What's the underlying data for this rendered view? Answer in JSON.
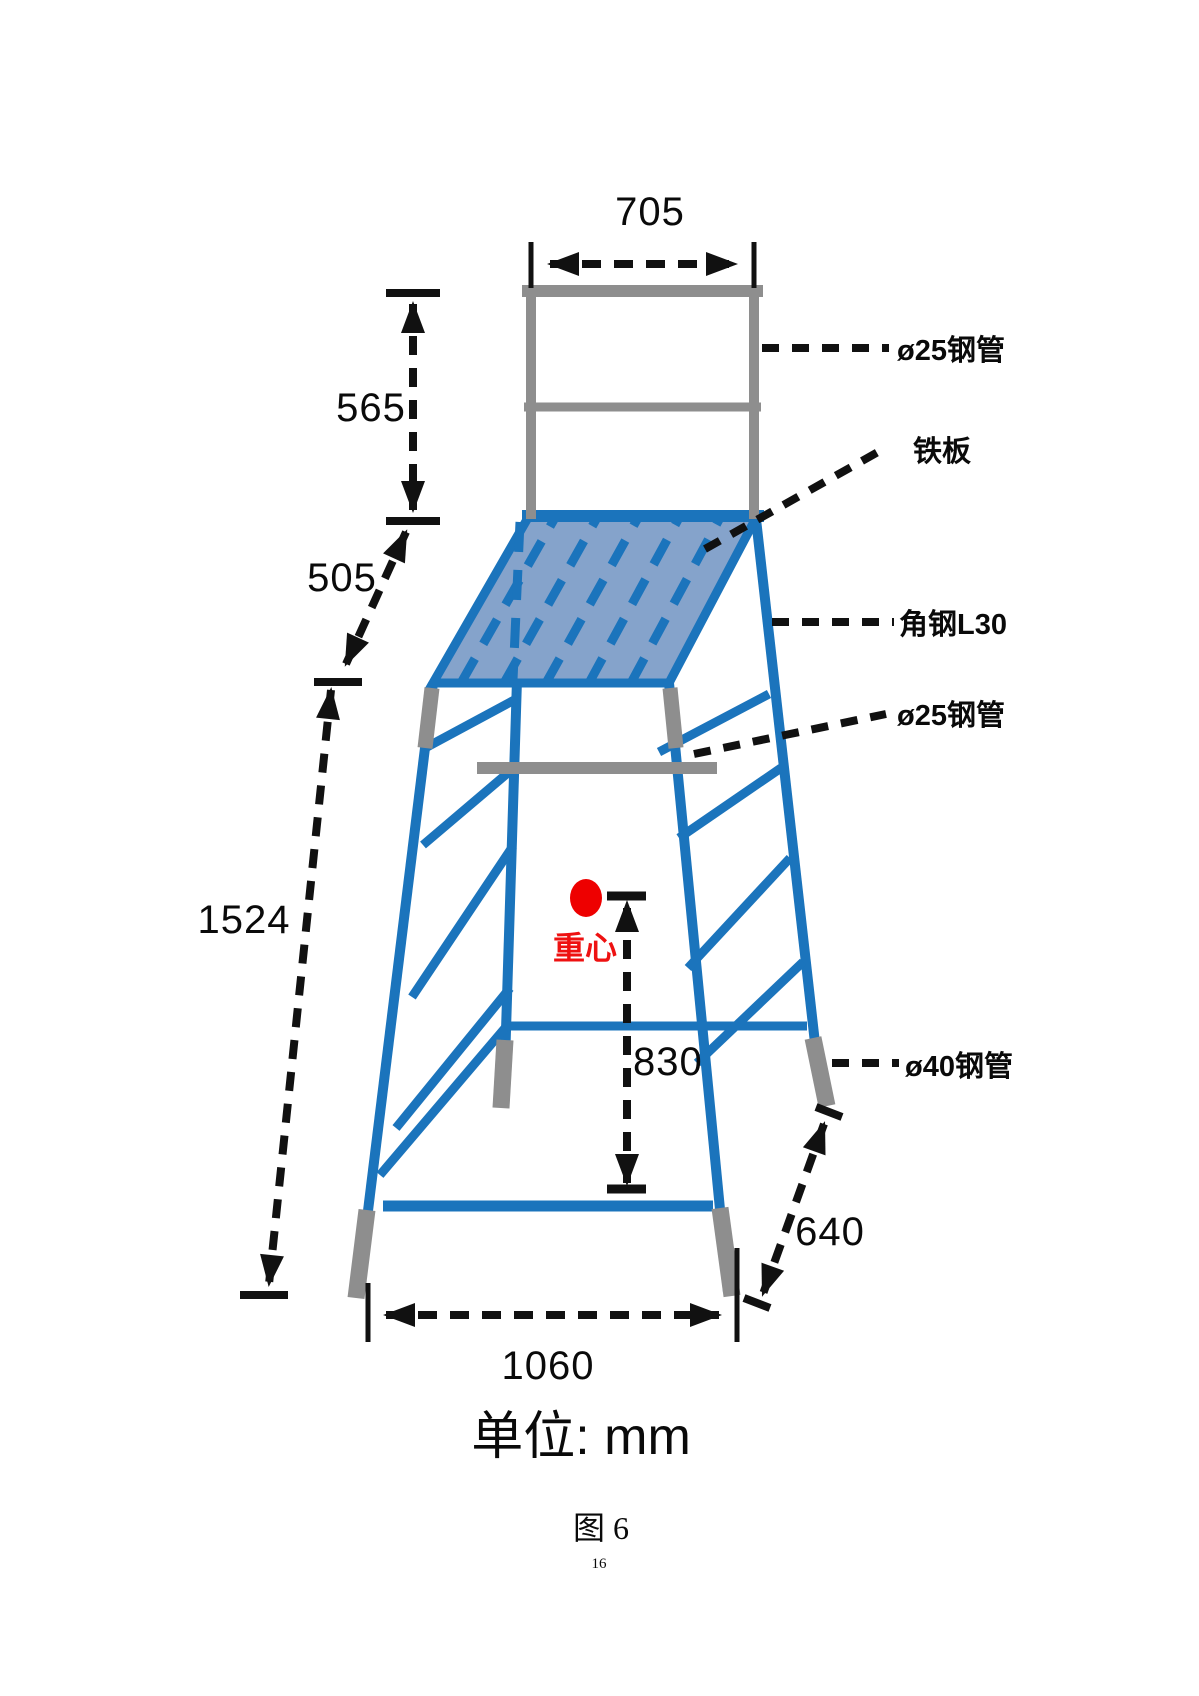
{
  "figure": {
    "unit_note": "单位: mm",
    "caption": "图 6",
    "page_number": "16"
  },
  "dimensions": {
    "top_frame_width": "705",
    "backrest_height": "565",
    "frame_to_platform": "505",
    "overall_height": "1524",
    "center_of_gravity_height": "830",
    "base_depth": "640",
    "base_width": "1060"
  },
  "annotations": {
    "pipe25_top": "ø25钢管",
    "iron_plate": "铁板",
    "angle_steel": "角钢L30",
    "pipe25_mid": "ø25钢管",
    "pipe40": "ø40钢管",
    "center_of_gravity": "重心"
  },
  "colors": {
    "structure_blue": "#1b74bc",
    "platform_fill": "#85a3cb",
    "steel_gray": "#8e8e8e",
    "marker_red": "#ee0000",
    "dimension_black": "#111111"
  }
}
